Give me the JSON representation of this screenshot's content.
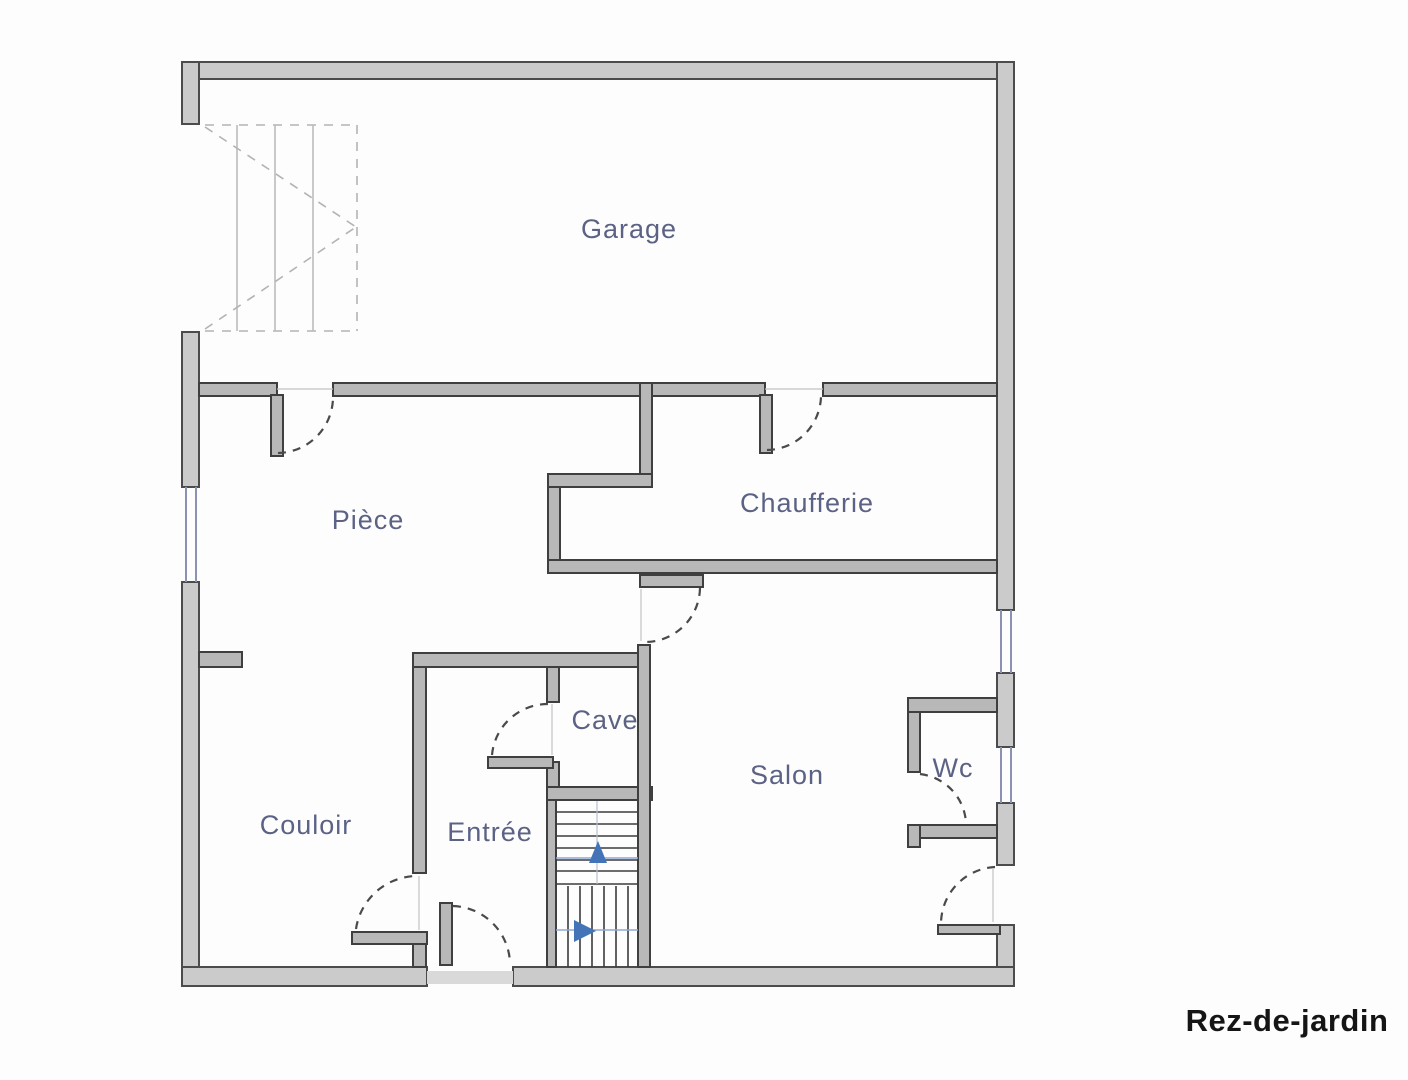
{
  "floor_plan": {
    "title": "Rez-de-jardin",
    "rooms": {
      "garage": {
        "label": "Garage"
      },
      "piece": {
        "label": "Pièce"
      },
      "chaufferie": {
        "label": "Chaufferie"
      },
      "cave": {
        "label": "Cave"
      },
      "salon": {
        "label": "Salon"
      },
      "wc": {
        "label": "Wc"
      },
      "couloir": {
        "label": "Couloir"
      },
      "entree": {
        "label": "Entrée"
      }
    },
    "colors": {
      "background": "#fdfdfd",
      "wall_fill": "#cbcbcb",
      "wall_edge": "#4c4c4c",
      "interior_wall_fill": "#b8b8b8",
      "door_arc": "#4a4a4a",
      "window_blue": "#8a92b4",
      "stair_tread": "#3c3c3c",
      "stair_arrow_blue": "#4374b8",
      "dashed_stair_gray": "#b3b3b3",
      "room_label": "#5c6285",
      "title": "#151515"
    },
    "icons": {
      "stairs_up_arrow": "triangle-up",
      "stairs_forward_arrow": "triangle-right"
    }
  }
}
